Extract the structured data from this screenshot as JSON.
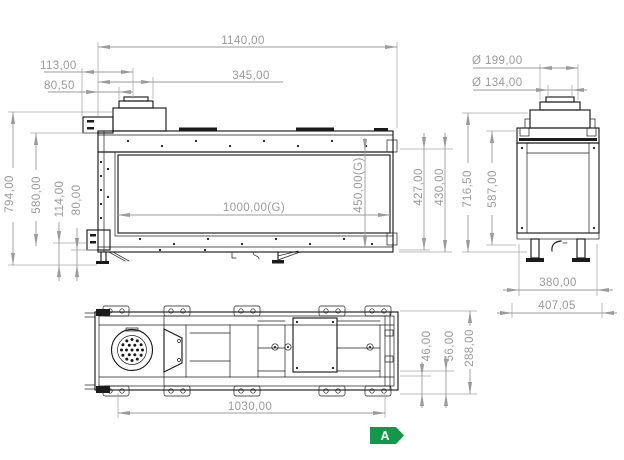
{
  "colors": {
    "geometry": "#1b1b1b",
    "dimension_gray": "#9b9b9b",
    "energy_green": "#13984b",
    "background": "#ffffff"
  },
  "dims": {
    "front": {
      "total_width": "1140,00",
      "offset_113": "113,00",
      "offset_80_5": "80,50",
      "offset_345": "345,00",
      "total_height": "794,00",
      "body_height": "580,00",
      "height_114": "114,00",
      "height_80": "80,00",
      "glass_width": "1000,00(G)",
      "glass_height": "450,00(G)",
      "height_427": "427,00",
      "height_430": "430,00"
    },
    "side": {
      "flue_outer_dia": "Ø 199,00",
      "flue_inner_dia": "Ø 134,00",
      "total_height": "716,50",
      "body_height": "587,00",
      "depth_380": "380,00",
      "depth_407": "407,05"
    },
    "plan": {
      "base_width": "1030,00",
      "depth_46": "46,00",
      "depth_56": "56,00",
      "total_depth": "288,00"
    }
  },
  "energy_label": {
    "class_letter": "A"
  }
}
